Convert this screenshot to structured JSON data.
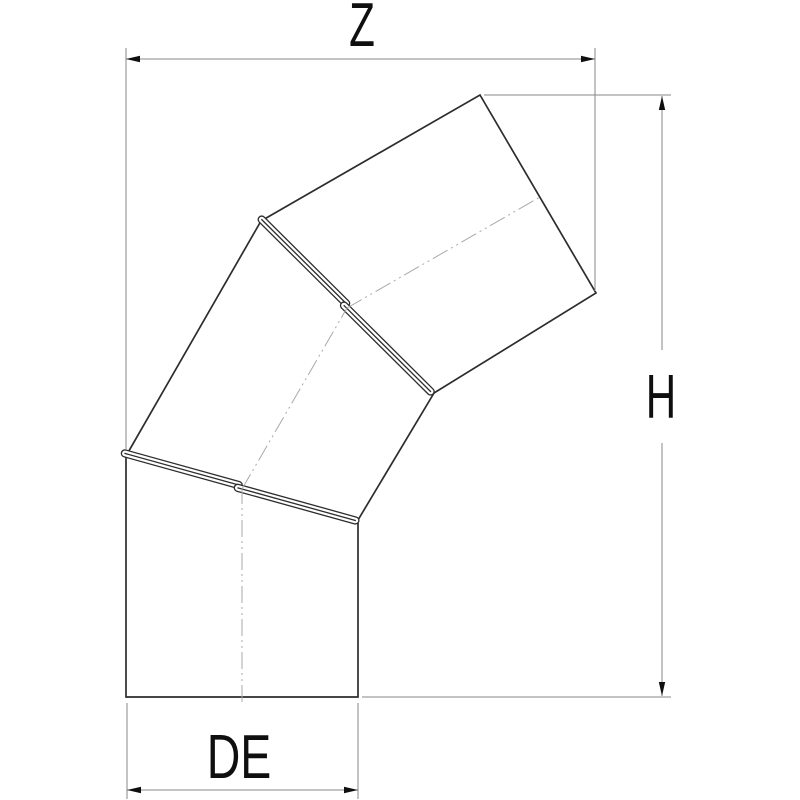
{
  "description": "Technical line drawing of a three-segment adjustable pipe elbow with two crimped rotating seam joints, annotated with dimension lines",
  "dimensions": {
    "top_width_label": "Z",
    "right_height_label": "H",
    "bottom_diameter_label": "DE"
  },
  "colors": {
    "background": "#ffffff",
    "object_line": "#2d2d2d",
    "dimension_line": "#878787",
    "centerline": "#a9a9a9",
    "arrowhead": "#0f0f0f",
    "label_text": "#0f0f0f"
  }
}
